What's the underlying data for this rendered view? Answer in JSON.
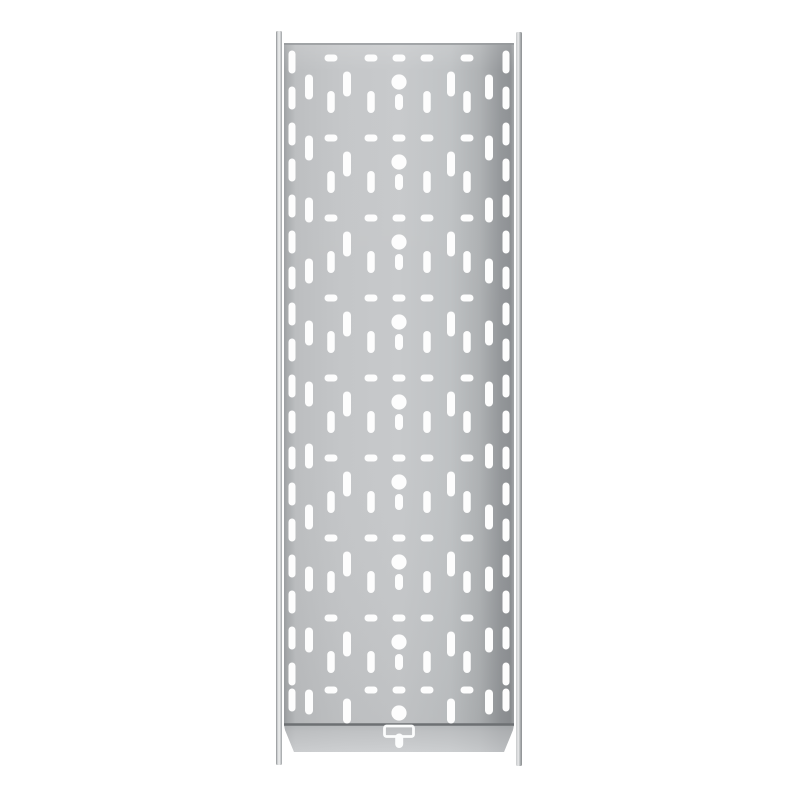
{
  "image": {
    "subject": "perforated-galvanized-steel-cable-tray-top-view",
    "background_color": "#ffffff"
  },
  "colors": {
    "hole": "#fdfdfd",
    "plate_top_edge": "#94979a",
    "fold_line": "#6d7073",
    "t_slot": "#fcfdfd",
    "plate_gradient_h": [
      [
        0,
        "#9b9ea1"
      ],
      [
        0.015,
        "#a9acae"
      ],
      [
        0.05,
        "#bcbec0"
      ],
      [
        0.25,
        "#c4c6c8"
      ],
      [
        0.5,
        "#c7c9cb"
      ],
      [
        0.72,
        "#bfc2c4"
      ],
      [
        0.85,
        "#aeb1b3"
      ],
      [
        0.94,
        "#94979a"
      ],
      [
        0.985,
        "#8d9093"
      ],
      [
        1,
        "#a2a5a7"
      ]
    ],
    "plate_sheen_v": [
      [
        0,
        "rgba(255,255,255,0.14)"
      ],
      [
        0.04,
        "rgba(255,255,255,0.02)"
      ],
      [
        0.5,
        "rgba(255,255,255,0)"
      ],
      [
        1,
        "rgba(0,0,0,0.04)"
      ]
    ],
    "flange_gradient_v": [
      [
        0,
        "#afb2b4"
      ],
      [
        0.25,
        "#bdbfc1"
      ],
      [
        1,
        "#d2d4d6"
      ]
    ],
    "rail_left_gradient_h": [
      [
        0,
        "#8c8f91"
      ],
      [
        0.3,
        "#d9dbdc"
      ],
      [
        0.55,
        "#eceded"
      ],
      [
        0.8,
        "#c2c4c6"
      ],
      [
        1,
        "#9ea1a3"
      ]
    ],
    "rail_right_gradient_h": [
      [
        0,
        "#c6c8ca"
      ],
      [
        0.4,
        "#e8e9ea"
      ],
      [
        0.75,
        "#a8abad"
      ],
      [
        1,
        "#8a8d8f"
      ]
    ]
  },
  "geometry": {
    "canvas": {
      "w": 800,
      "h": 800
    },
    "plate": {
      "x": 284,
      "y": 43,
      "w": 230,
      "h": 682
    },
    "center_x": 399,
    "rail_left": {
      "x": 276,
      "y": 31,
      "w": 6,
      "h": 734
    },
    "rail_right": {
      "x": 516,
      "y": 32,
      "w": 6,
      "h": 734
    },
    "fold_line": {
      "y": 724.5,
      "x1": 284,
      "x2": 514,
      "width": 2.4
    },
    "flange_points": "284,725 514,725 513,730 504,752 294,752 285,730",
    "t_slot": {
      "bar": {
        "x": 384.5,
        "y": 726,
        "w": 29,
        "h": 10.5,
        "rx": 2,
        "stroke_width": 2.8
      },
      "stem": {
        "x": 395.2,
        "y": 733.5,
        "w": 8,
        "h": 14.5,
        "rx": 4
      }
    }
  },
  "pattern": {
    "circles": {
      "r": 7.6,
      "ys": [
        82,
        162,
        242,
        322,
        402,
        482,
        562,
        642,
        713
      ]
    },
    "center_slots": {
      "w": 8,
      "len": 16,
      "ys": [
        102,
        182,
        262,
        342,
        422,
        502,
        582,
        662
      ]
    },
    "dash_rows": {
      "w": 13,
      "h": 7,
      "x_offsets": [
        -68,
        -28,
        0,
        28,
        68
      ],
      "ys": [
        58,
        138,
        218,
        298,
        378,
        458,
        538,
        618,
        690
      ]
    },
    "slot_columns": [
      {
        "x_offset": -107,
        "w": 7,
        "len": 23,
        "ys": [
          62,
          98,
          134,
          170,
          206,
          242,
          278,
          314,
          350,
          386,
          422,
          458,
          494,
          530,
          566,
          602,
          638,
          674,
          700
        ]
      },
      {
        "x_offset": 107,
        "w": 7,
        "len": 23,
        "ys": [
          62,
          98,
          134,
          170,
          206,
          242,
          278,
          314,
          350,
          386,
          422,
          458,
          494,
          530,
          566,
          602,
          638,
          674,
          700
        ]
      },
      {
        "x_offset": -90,
        "w": 8,
        "len": 25,
        "ys": [
          87,
          148,
          210,
          271,
          333,
          394,
          456,
          517,
          579,
          640,
          702
        ]
      },
      {
        "x_offset": 90,
        "w": 8,
        "len": 25,
        "ys": [
          87,
          148,
          210,
          271,
          333,
          394,
          456,
          517,
          579,
          640,
          702
        ]
      },
      {
        "x_offset": -52,
        "w": 8,
        "len": 25,
        "ys": [
          84,
          164,
          244,
          324,
          404,
          484,
          564,
          644,
          711
        ]
      },
      {
        "x_offset": 52,
        "w": 8,
        "len": 25,
        "ys": [
          84,
          164,
          244,
          324,
          404,
          484,
          564,
          644,
          711
        ]
      },
      {
        "x_offset": -68,
        "w": 7.5,
        "len": 22,
        "ys": [
          102,
          182,
          262,
          342,
          422,
          502,
          582,
          662
        ]
      },
      {
        "x_offset": 68,
        "w": 7.5,
        "len": 22,
        "ys": [
          102,
          182,
          262,
          342,
          422,
          502,
          582,
          662
        ]
      },
      {
        "x_offset": -28,
        "w": 7.5,
        "len": 22,
        "ys": [
          102,
          182,
          262,
          342,
          422,
          502,
          582,
          662
        ]
      },
      {
        "x_offset": 28,
        "w": 7.5,
        "len": 22,
        "ys": [
          102,
          182,
          262,
          342,
          422,
          502,
          582,
          662
        ]
      }
    ]
  }
}
